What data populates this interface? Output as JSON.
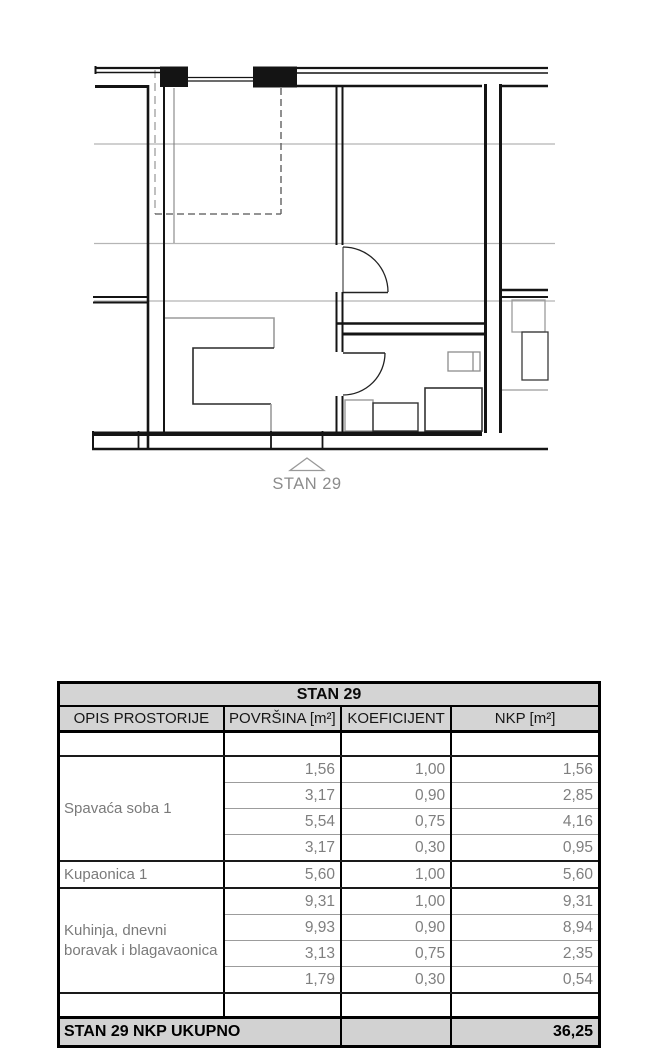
{
  "plan": {
    "marker_label": "STAN 29"
  },
  "table": {
    "title": "STAN 29",
    "columns": [
      "OPIS PROSTORIJE",
      "POVRŠINA [m²]",
      "KOEFICIJENT",
      "NKP [m²]"
    ],
    "groups": [
      {
        "name": "Spavaća soba 1",
        "rows": [
          [
            "1,56",
            "1,00",
            "1,56"
          ],
          [
            "3,17",
            "0,90",
            "2,85"
          ],
          [
            "5,54",
            "0,75",
            "4,16"
          ],
          [
            "3,17",
            "0,30",
            "0,95"
          ]
        ]
      },
      {
        "name": "Kupaonica 1",
        "rows": [
          [
            "5,60",
            "1,00",
            "5,60"
          ]
        ]
      },
      {
        "name": "Kuhinja, dnevni boravak i blagavaonica",
        "rows": [
          [
            "9,31",
            "1,00",
            "9,31"
          ],
          [
            "9,93",
            "0,90",
            "8,94"
          ],
          [
            "3,13",
            "0,75",
            "2,35"
          ],
          [
            "1,79",
            "0,30",
            "0,54"
          ]
        ]
      }
    ],
    "total_label": "STAN 29 NKP UKUPNO",
    "total_value": "36,25"
  },
  "colors": {
    "wall": "#141414",
    "furniture_gray": "#9b9b9b",
    "reference_line": "#b5b5b5",
    "header_bg": "#d4d4d4",
    "data_text": "#7f7f7f",
    "plan_label_text": "#8c8c8c"
  }
}
